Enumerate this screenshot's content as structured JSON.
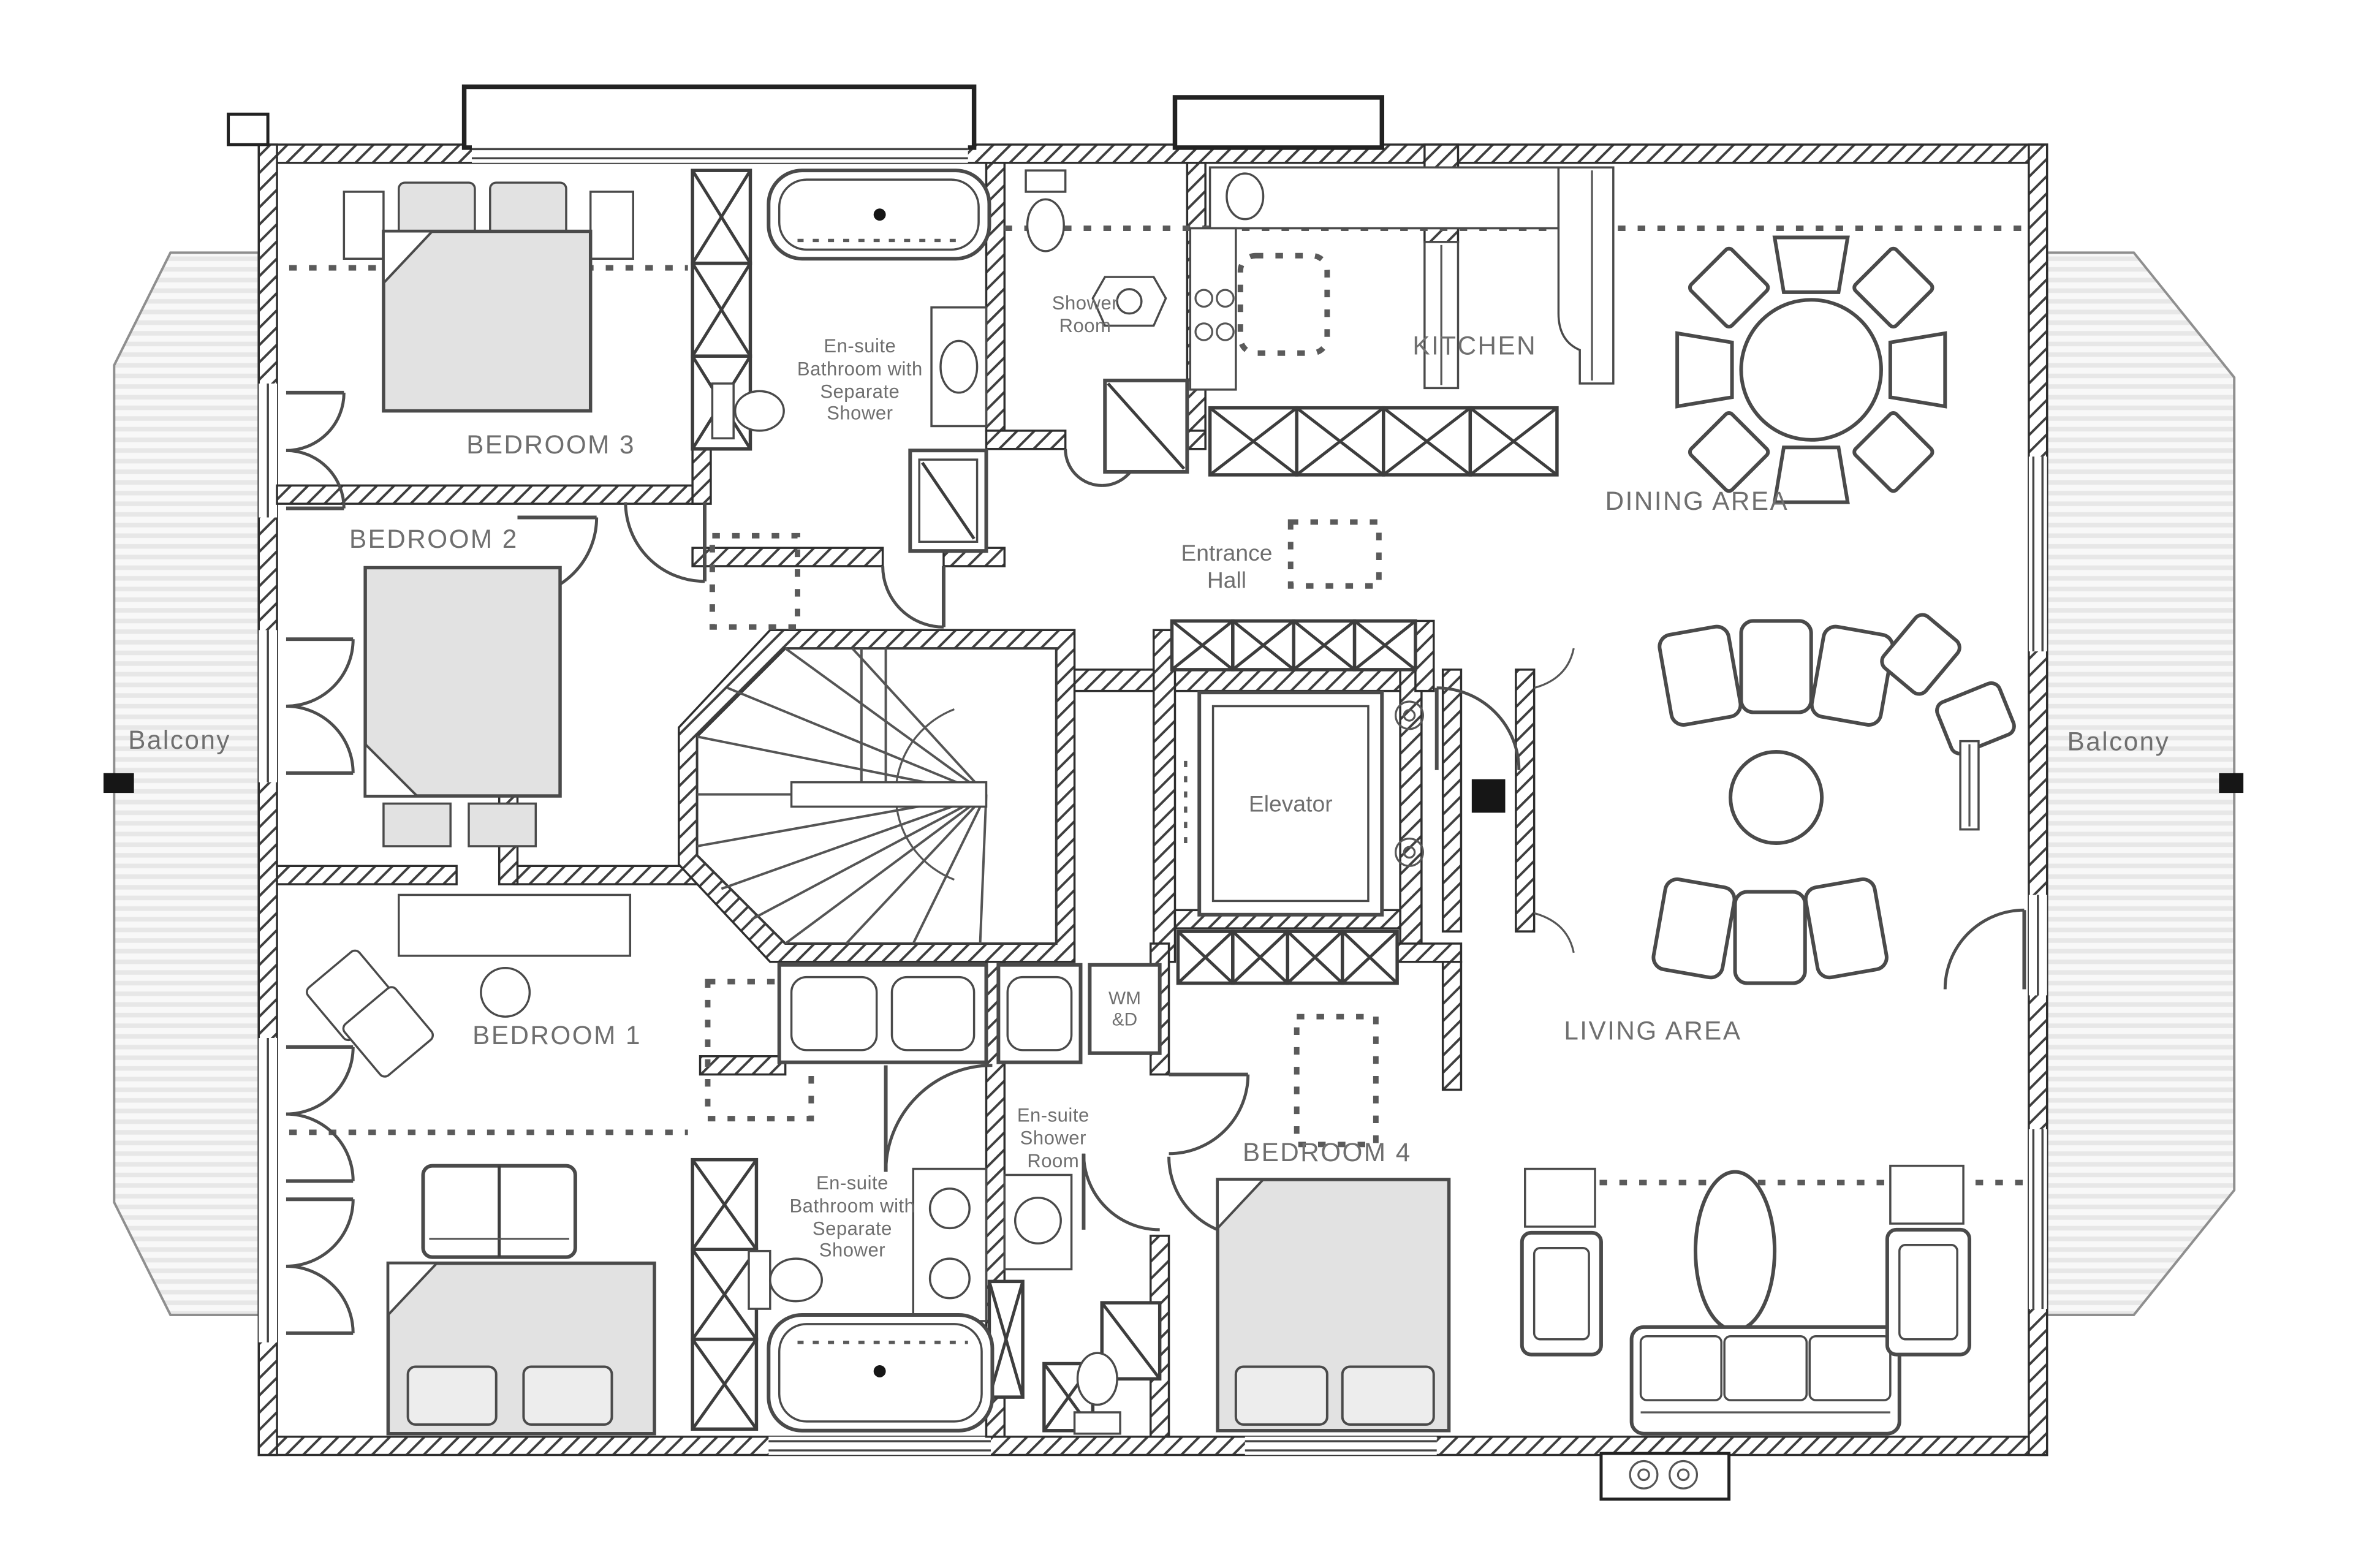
{
  "rooms": {
    "bedroom1": "BEDROOM 1",
    "bedroom2": "BEDROOM 2",
    "bedroom3": "BEDROOM 3",
    "bedroom4": "BEDROOM 4",
    "kitchen": "KITCHEN",
    "dining_area": "DINING AREA",
    "living_area": "LIVING AREA",
    "entrance_hall": "Entrance Hall",
    "balcony_left": "Balcony",
    "balcony_right": "Balcony"
  },
  "fixtures": {
    "elevator": "Elevator",
    "shower_room": "Shower Room",
    "ensuite_bathroom_top": "En-suite Bathroom with Separate Shower",
    "ensuite_bathroom_bottom": "En-suite Bathroom with Separate Shower",
    "ensuite_shower_room": "En-suite Shower Room",
    "washer_dryer": "WM &D"
  },
  "colors": {
    "wall_line": "#2e2e2e",
    "hatch": "#3f3f3f",
    "furniture_line": "#4a4a4a",
    "bed_fill": "#e2e2e2",
    "balcony_stripe": "#e7e7e7",
    "label_text": "#6f6f6f",
    "background": "#ffffff",
    "dash": "#5a5a5a"
  }
}
